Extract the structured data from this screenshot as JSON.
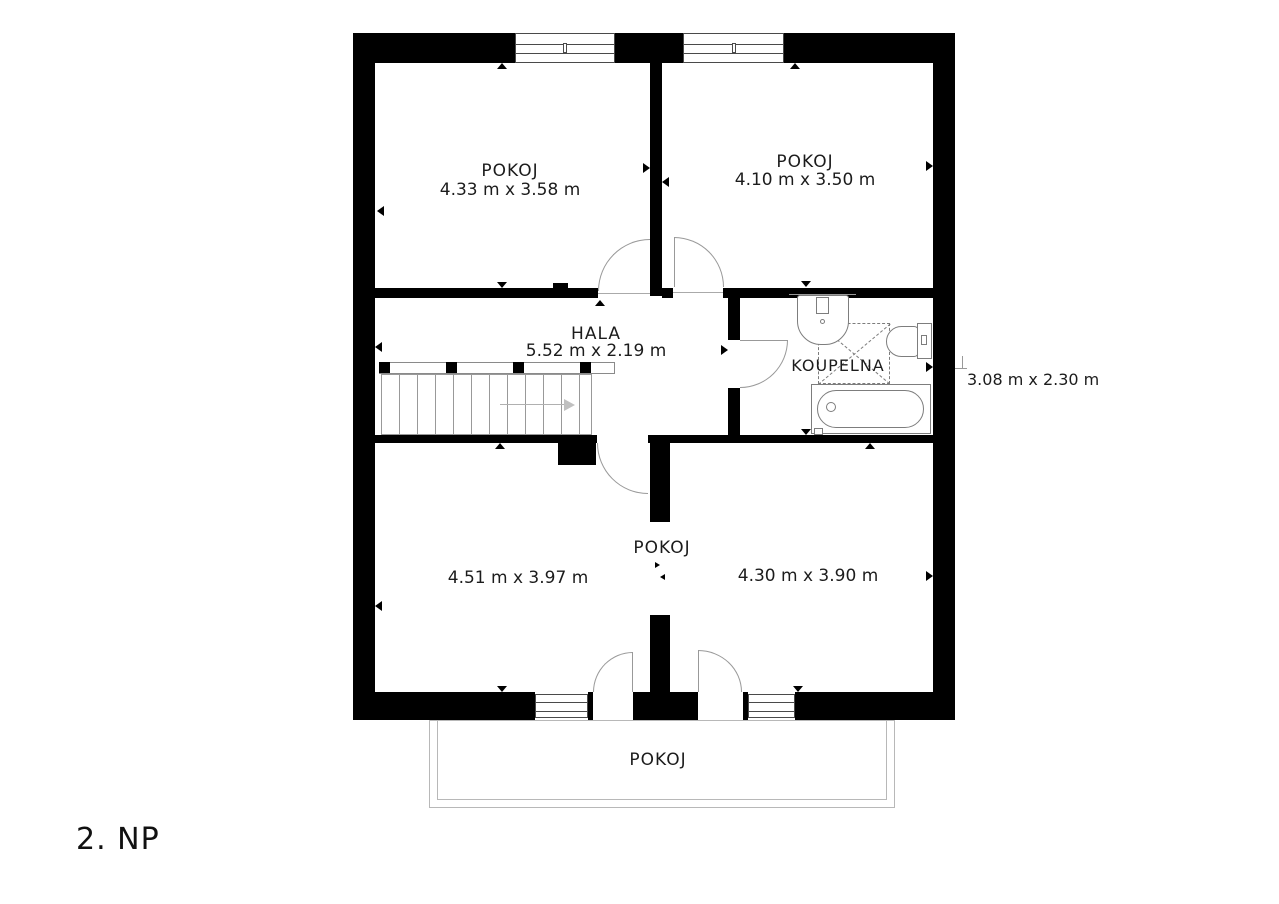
{
  "floor_label": "2. NP",
  "labels": {
    "room_top_left": {
      "name": "POKOJ",
      "dims": "4.33 m x 3.58 m"
    },
    "room_top_right": {
      "name": "POKOJ",
      "dims": "4.10 m x 3.50 m"
    },
    "hall": {
      "name": "HALA",
      "dims": "5.52 m x 2.19 m"
    },
    "bathroom": {
      "name": "KOUPELNA",
      "dims": "3.08 m x 2.30 m"
    },
    "room_bottom": {
      "name": "POKOJ",
      "dims_left": "4.51 m x 3.97 m",
      "dims_right": "4.30 m x 3.90 m"
    },
    "balcony_room": {
      "name": "POKOJ"
    }
  },
  "colors": {
    "wall": "#000000",
    "thin_line": "#999999",
    "fixture_line": "#7d7d7d",
    "balcony_line": "#b8b8b8",
    "text": "#1c1c1c",
    "background": "#ffffff"
  }
}
